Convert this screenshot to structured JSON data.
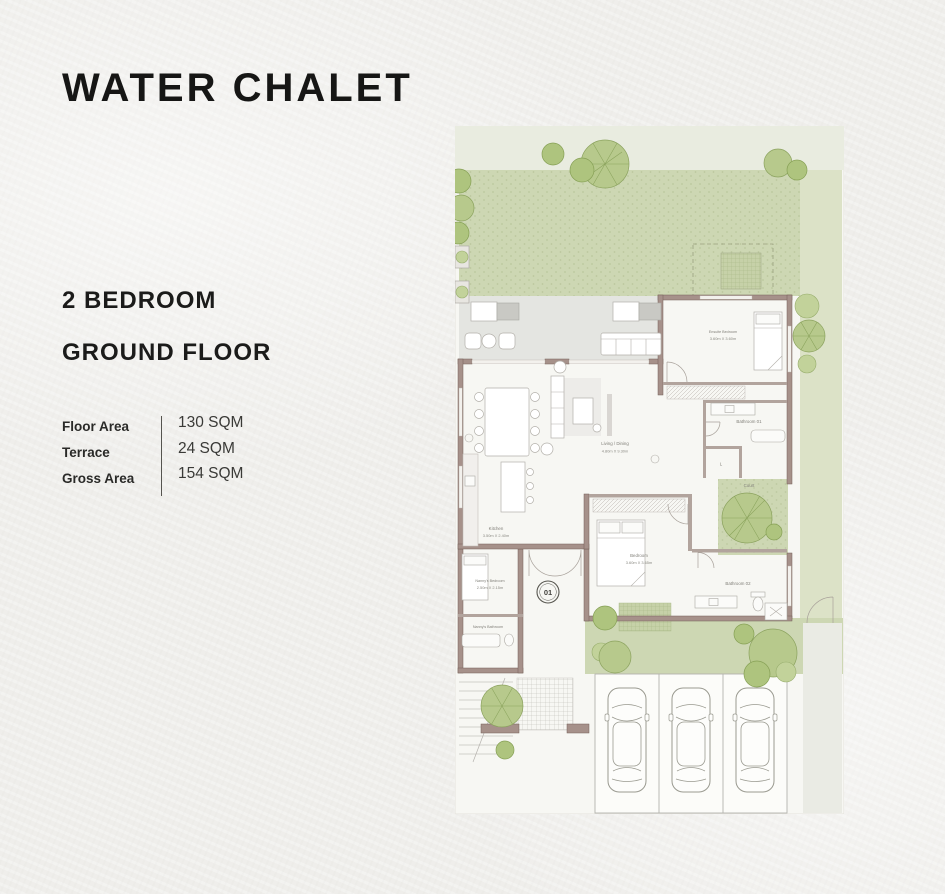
{
  "header": {
    "title": "WATER CHALET",
    "unit_type": "2 BEDROOM",
    "floor": "GROUND FLOOR"
  },
  "area_table": {
    "rows": [
      {
        "label": "Floor Area",
        "value": "130 SQM"
      },
      {
        "label": "Terrace",
        "value": "24 SQM"
      },
      {
        "label": "Gross Area",
        "value": "154 SQM"
      }
    ]
  },
  "floor_plan": {
    "unit_number": "01",
    "rooms": [
      {
        "name": "Living / Dining",
        "dims": "4.80m X 9.30m"
      },
      {
        "name": "Kitchen",
        "dims": "3.50m X 2.40m"
      },
      {
        "name": "Ensuite Bedroom",
        "dims": "3.60m X 3.60m"
      },
      {
        "name": "Bedroom",
        "dims": "3.60m X 3.65m"
      },
      {
        "name": "Nanny's Bedroom",
        "dims": "2.50m X 2.15m"
      },
      {
        "name": "Nanny's Bathroom"
      },
      {
        "name": "Bathroom 01"
      },
      {
        "name": "Bathroom 02"
      },
      {
        "name": "Court"
      },
      {
        "name": "L"
      }
    ],
    "colors": {
      "wall": "#a6918a",
      "garden_green": "#cdd7b3",
      "side_strip_green": "#dce2c7",
      "terrace_gray": "#e4e5e1",
      "tree_green": "#b7c98c",
      "sheet": "#f7f7f3",
      "label_text": "#807f78",
      "heading_text": "#161615"
    }
  }
}
